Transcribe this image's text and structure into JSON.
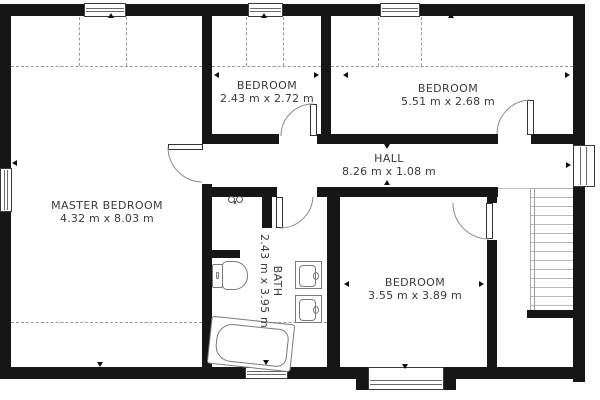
{
  "plan_title": "Upper floor plan",
  "rooms": [
    {
      "name": "MASTER BEDROOM",
      "dims": "4.32 m x 8.03 m"
    },
    {
      "name": "BEDROOM",
      "dims": "2.43 m x 2.72 m"
    },
    {
      "name": "BEDROOM",
      "dims": "5.51 m x 2.68 m"
    },
    {
      "name": "HALL",
      "dims": "8.26 m x 1.08 m"
    },
    {
      "name": "BATH",
      "dims": "2.43 m x 3.95 m"
    },
    {
      "name": "BEDROOM",
      "dims": "3.55 m x 3.89 m"
    }
  ],
  "colors": {
    "wall_hex": "#161616",
    "text_hex": "#3a3a3a",
    "fixture_outline_hex": "#7a7a7a",
    "dashed_line_hex": "#9a9a9a",
    "stair_tread_hex": "#b8b8b8"
  }
}
